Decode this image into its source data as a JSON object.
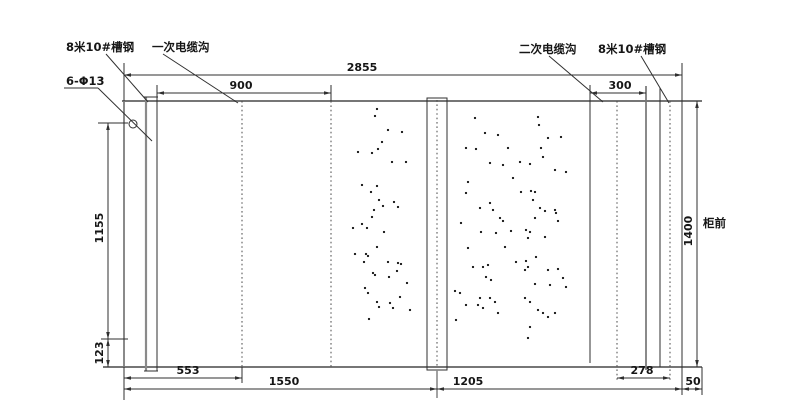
{
  "colors": {
    "line": "#2f2f2f",
    "border": "#767676",
    "background": "#ffffff",
    "dot": "#141414"
  },
  "callouts": [
    {
      "id": "channel-steel-left",
      "text": "8米10#槽钢",
      "x": 66,
      "y": 51,
      "leader": [
        106,
        54,
        148,
        102
      ]
    },
    {
      "id": "primary-cable-trench",
      "text": "一次电缆沟",
      "x": 152,
      "y": 51,
      "leader": [
        163,
        54,
        238,
        103
      ]
    },
    {
      "id": "secondary-cable-trench",
      "text": "二次电缆沟",
      "x": 519,
      "y": 53,
      "leader": [
        549,
        56,
        603,
        102
      ]
    },
    {
      "id": "channel-steel-right",
      "text": "8米10#槽钢",
      "x": 598,
      "y": 53,
      "leader": [
        641,
        56,
        669,
        103
      ]
    },
    {
      "id": "hole-spec",
      "text": "6-Φ13",
      "x": 66,
      "y": 85,
      "leader": [
        98,
        88,
        152,
        141
      ],
      "underline": [
        64,
        88,
        98,
        88
      ]
    },
    {
      "id": "cabinet-front",
      "text": "柜前",
      "x": 703,
      "y": 227,
      "leader": null
    }
  ],
  "dimensions": [
    {
      "id": "overall-width",
      "value": "2855",
      "dir": "h",
      "y": 75,
      "x1": 124,
      "x2": 682,
      "tx": 362
    },
    {
      "id": "primary-trench-width",
      "value": "900",
      "dir": "h",
      "y": 93,
      "x1": 157,
      "x2": 331,
      "tx": 241
    },
    {
      "id": "secondary-trench-width",
      "value": "300",
      "dir": "h",
      "y": 93,
      "x1": 590,
      "x2": 646,
      "tx": 620
    },
    {
      "id": "cabinet-depth",
      "value": "1400",
      "dir": "v",
      "x": 697,
      "y1": 101,
      "y2": 367,
      "ty": 231
    },
    {
      "id": "left-upper-height",
      "value": "1155",
      "dir": "v",
      "x": 108,
      "y1": 123,
      "y2": 339,
      "ty": 228
    },
    {
      "id": "left-lower-height",
      "value": "123",
      "dir": "v",
      "x": 108,
      "y1": 339,
      "y2": 367,
      "ty": 353
    },
    {
      "id": "bottom-553",
      "value": "553",
      "dir": "h",
      "y": 378,
      "x1": 124,
      "x2": 242,
      "tx": 188
    },
    {
      "id": "bottom-1550",
      "value": "1550",
      "dir": "h",
      "y": 389,
      "x1": 124,
      "x2": 437,
      "tx": 284
    },
    {
      "id": "bottom-1205",
      "value": "1205",
      "dir": "h",
      "y": 389,
      "x1": 437,
      "x2": 682,
      "tx": 468
    },
    {
      "id": "bottom-278",
      "value": "278",
      "dir": "h",
      "y": 378,
      "x1": 617,
      "x2": 670,
      "tx": 642
    },
    {
      "id": "bottom-50",
      "value": "50",
      "dir": "h",
      "y": 389,
      "x1": 682,
      "x2": 702,
      "tx": 693
    }
  ],
  "dots_left": [
    [
      377,
      109
    ],
    [
      375,
      116
    ],
    [
      388,
      130
    ],
    [
      402,
      132
    ],
    [
      382,
      142
    ],
    [
      378,
      149
    ],
    [
      358,
      152
    ],
    [
      372,
      153
    ],
    [
      392,
      162
    ],
    [
      406,
      162
    ],
    [
      362,
      185
    ],
    [
      377,
      186
    ],
    [
      371,
      192
    ],
    [
      379,
      200
    ],
    [
      394,
      202
    ],
    [
      383,
      206
    ],
    [
      398,
      207
    ],
    [
      374,
      210
    ],
    [
      372,
      217
    ],
    [
      362,
      224
    ],
    [
      353,
      228
    ],
    [
      367,
      228
    ],
    [
      384,
      232
    ],
    [
      377,
      247
    ],
    [
      355,
      254
    ],
    [
      366,
      254
    ],
    [
      368,
      256
    ],
    [
      364,
      262
    ],
    [
      388,
      262
    ],
    [
      398,
      263
    ],
    [
      401,
      264
    ],
    [
      397,
      271
    ],
    [
      373,
      273
    ],
    [
      375,
      275
    ],
    [
      389,
      277
    ],
    [
      407,
      283
    ],
    [
      365,
      288
    ],
    [
      368,
      293
    ],
    [
      400,
      297
    ],
    [
      377,
      302
    ],
    [
      390,
      303
    ],
    [
      379,
      307
    ],
    [
      393,
      308
    ],
    [
      410,
      310
    ],
    [
      369,
      319
    ]
  ],
  "dots_right": [
    [
      475,
      118
    ],
    [
      538,
      117
    ],
    [
      539,
      125
    ],
    [
      485,
      133
    ],
    [
      498,
      135
    ],
    [
      548,
      138
    ],
    [
      561,
      137
    ],
    [
      466,
      148
    ],
    [
      476,
      149
    ],
    [
      508,
      148
    ],
    [
      541,
      148
    ],
    [
      543,
      157
    ],
    [
      490,
      163
    ],
    [
      503,
      165
    ],
    [
      520,
      162
    ],
    [
      530,
      164
    ],
    [
      555,
      170
    ],
    [
      566,
      172
    ],
    [
      513,
      178
    ],
    [
      468,
      182
    ],
    [
      466,
      193
    ],
    [
      521,
      192
    ],
    [
      531,
      191
    ],
    [
      535,
      192
    ],
    [
      533,
      200
    ],
    [
      490,
      203
    ],
    [
      480,
      208
    ],
    [
      493,
      210
    ],
    [
      540,
      208
    ],
    [
      545,
      211
    ],
    [
      555,
      210
    ],
    [
      556,
      213
    ],
    [
      500,
      218
    ],
    [
      503,
      221
    ],
    [
      535,
      218
    ],
    [
      558,
      221
    ],
    [
      461,
      223
    ],
    [
      481,
      232
    ],
    [
      496,
      233
    ],
    [
      511,
      231
    ],
    [
      526,
      230
    ],
    [
      530,
      232
    ],
    [
      528,
      238
    ],
    [
      545,
      237
    ],
    [
      468,
      248
    ],
    [
      505,
      247
    ],
    [
      536,
      257
    ],
    [
      516,
      262
    ],
    [
      526,
      261
    ],
    [
      528,
      267
    ],
    [
      525,
      270
    ],
    [
      473,
      267
    ],
    [
      483,
      267
    ],
    [
      488,
      265
    ],
    [
      548,
      270
    ],
    [
      558,
      269
    ],
    [
      486,
      277
    ],
    [
      491,
      280
    ],
    [
      563,
      278
    ],
    [
      550,
      285
    ],
    [
      535,
      284
    ],
    [
      566,
      287
    ],
    [
      455,
      291
    ],
    [
      460,
      293
    ],
    [
      480,
      298
    ],
    [
      490,
      298
    ],
    [
      495,
      302
    ],
    [
      466,
      305
    ],
    [
      478,
      305
    ],
    [
      483,
      308
    ],
    [
      498,
      313
    ],
    [
      525,
      298
    ],
    [
      530,
      302
    ],
    [
      538,
      310
    ],
    [
      543,
      313
    ],
    [
      555,
      313
    ],
    [
      548,
      317
    ],
    [
      456,
      320
    ],
    [
      530,
      327
    ],
    [
      528,
      338
    ]
  ]
}
